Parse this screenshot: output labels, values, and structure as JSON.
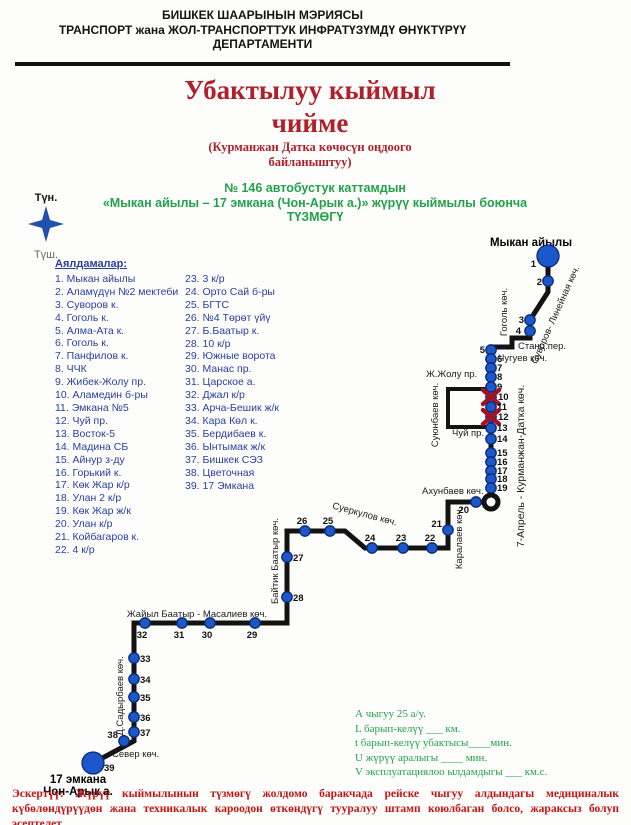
{
  "header": {
    "line1": "БИШКЕК ШААРЫНЫН МЭРИЯСЫ",
    "line2": "ТРАНСПОРТ жана ЖОЛ-ТРАНСПОРТТУК ИНФРАТҮЗҮМДҮ ӨНҮКТҮРҮҮ",
    "line3": "ДЕПАРТАМЕНТИ"
  },
  "title": {
    "line1": "Убактылуу кыймыл",
    "line2": "чийме",
    "sub1": "(Курманжан Датка көчөсүн оңдоого",
    "sub2": "байланыштуу)"
  },
  "route_info": {
    "line1": "№ 146 автобустук каттамдын",
    "line2": "«Мыкан айылы – 17 эмкана (Чон-Арык а.)» жүрүү кыймылы боюнча",
    "line3": "ТҮЗМӨГҮ"
  },
  "compass": {
    "north": "Түн.",
    "south": "Түш."
  },
  "stops_list": {
    "heading": "Аялдамалар:",
    "column1": [
      "1. Мыкан айылы",
      "2. Аламүдүн №2 мектеби",
      "3. Суворов к.",
      "4. Гоголь к.",
      "5. Алма-Ата к.",
      "6. Гоголь к.",
      "7. Панфилов к.",
      "8. ЧЧК",
      "9. Жибек-Жолу пр.",
      "10. Аламедин б-ры",
      "11. Эмкана №5",
      "12. Чуй пр.",
      "13. Восток-5",
      "14. Мадина СБ",
      "15. Айнур з-ду",
      "16. Горький к.",
      "17. Көк Жар к/р",
      "18. Улан 2 к/р",
      "19. Көк Жар ж/к",
      "20. Улан к/р",
      "21. Койбагаров к.",
      "22. 4 к/р"
    ],
    "column2": [
      "23.  3 к/р",
      "24. Орто Сай б-ры",
      "25.  БГТС",
      "26.  №4 Төрөт үйү",
      "27. Б.Баатыр к.",
      "28. 10 к/р",
      "29. Южные ворота",
      "30. Манас пр.",
      "31. Царское а.",
      "32. Джал к/р",
      "33. Арча-Бешик ж/к",
      "34. Кара Көл к.",
      "35. Бердибаев к.",
      "36. Ынтымак ж/к",
      "37. Бишкек СЭЗ",
      "38. Цветочная",
      "39. 17 Эмкана"
    ]
  },
  "map": {
    "terminals": {
      "start": "Мыкан айылы",
      "end1": "17 эмкана",
      "end2": "Чон-Арык а."
    },
    "streets": {
      "suvorov": "Суворов- Линейная көч.",
      "gogol": "Гоголь көч.",
      "stanc": "Станц.пер.",
      "chuguev": "Чугуев көч.",
      "jzholu": "Ж.Жолу пр.",
      "suyunbaev": "Суюнбаев көч.",
      "chui": "Чуй пр.",
      "kurmanjan": "7-Апрель - Курманжан-Датка көч.",
      "akhunbaev": "Ахунбаев көч.",
      "karalaev": "Каралаев көч.",
      "suerkulov": "Суеркулов көч.",
      "baytik": "Байтик Баатыр көч.",
      "zhayil": "Жайыл Баатыр  - Масалиев көч.",
      "sadyrbaev": "Д.Садырбаев көч.",
      "sever": "Север көч."
    },
    "stop_numbers": [
      "1",
      "2",
      "3",
      "4",
      "5",
      "6",
      "7",
      "8",
      "9",
      "10",
      "11",
      "12",
      "13",
      "14",
      "15",
      "16",
      "17",
      "18",
      "19",
      "20",
      "21",
      "22",
      "23",
      "24",
      "25",
      "26",
      "27",
      "28",
      "29",
      "30",
      "31",
      "32",
      "33",
      "34",
      "35",
      "36",
      "37",
      "38",
      "39"
    ],
    "closed_stops": [
      10,
      12
    ]
  },
  "legend": {
    "lines": [
      "А чыгуу   25   а/у.",
      "L барып-келүү ___ км.",
      "t барып-келүү убактысы____мин.",
      "U жүрүү аралыгы ____    мин.",
      "V эксплуатациялоо ылдамдыгы ___ км.с."
    ]
  },
  "note": {
    "label": "Эскертүү:",
    "text": " Жүрүү кыймылынын түзмөгү жолдомо баракчада рейске чыгуу алдындагы медициналык күбөлөндүрүүдөн жана техникалык кароодон өткөндүгү тууралуу штамп коюлбаган болсо, жараксыз болуп эсептелет."
  },
  "colors": {
    "stop_blue": "#1d57cc",
    "stop_blue_stroke": "#0a2a70",
    "line_black": "#131313",
    "closed_red": "#a31220",
    "title_red": "#b01f2a",
    "green": "#23a24a",
    "list_blue": "#2a3fa0",
    "note_red": "#c41414"
  }
}
